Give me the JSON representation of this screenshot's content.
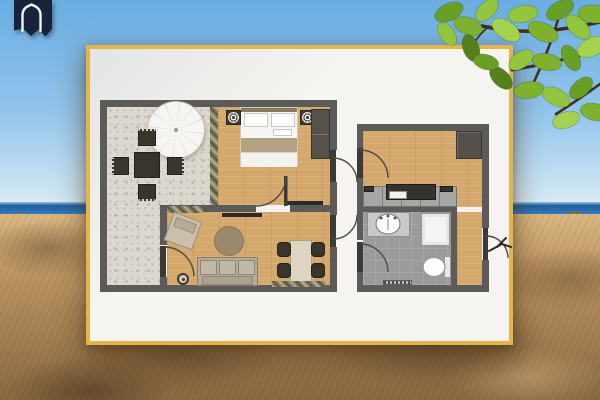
{
  "colors": {
    "sky_top": "#69ade2",
    "sky_mid": "#93c5ec",
    "sky_horizon": "#d8eaf5",
    "sea": "#2e74b5",
    "sea_dark": "#1d5f9f",
    "sand": "#bf9663",
    "sand_light": "#dcb983",
    "sand_dark": "#8a6a42",
    "sand_deep": "#5a4226",
    "card_bg": "#f6f4f0",
    "card_border": "#e5b44a",
    "wall": "#5c5b59",
    "wood": "#d5a96d",
    "patio": "#dcd8d0",
    "bath_floor": "#9c9b99",
    "entry_wood": "#d8ae75",
    "cabinet": "#a7a7a5",
    "counter_dark": "#343330",
    "furn_dark": "#38352c",
    "sofa": "#b6ac9a",
    "rug": "#9b8a6d",
    "table_cream": "#ded5c2",
    "blanket_tan": "#b2a183",
    "wardrobe": "#56524b",
    "hedge_a": "#7d8560",
    "hedge_b": "#66604e",
    "leaf_1": "#7fb02e",
    "leaf_2": "#94c53e",
    "leaf_3": "#689f25",
    "leaf_4": "#a6d14e",
    "leaf_5": "#55801c",
    "branch": "#42301e",
    "arc": "#4c4b49",
    "logo_navy": "#16233a",
    "logo_mark": "#f2f2f0"
  },
  "logo": {
    "icon": "house-arch-ribbon-icon"
  },
  "background": {
    "sky": "clear blue sky",
    "sea": "ocean horizon band",
    "beach": "sandy beach foreground",
    "foliage": "green tree branch overhanging top-right corner"
  },
  "card": {
    "kind": "white card with gold border holding the floor plan"
  },
  "floor_plan": {
    "style": "2d rendered top view, no text labels",
    "rooms": [
      {
        "name": "patio-terrace",
        "furniture": [
          "parasol",
          "outdoor-dining-table",
          "outdoor-chair x4"
        ]
      },
      {
        "name": "bedroom",
        "furniture": [
          "double-bed",
          "ceiling-light x2",
          "wardrobe",
          "planter-hedge"
        ]
      },
      {
        "name": "living-room",
        "furniture": [
          "sofa",
          "armchair",
          "round-rug",
          "dining-table",
          "dining-chair x4",
          "potted-plant",
          "tv-console",
          "wall-shelf",
          "wall-plants x2"
        ]
      },
      {
        "name": "kitchen",
        "furniture": [
          "kitchen-counter",
          "cooktop",
          "corner-cabinet"
        ]
      },
      {
        "name": "bathroom",
        "furniture": [
          "vanity-sink",
          "shower",
          "toilet",
          "bath-mat"
        ]
      },
      {
        "name": "entry-hall",
        "furniture": [
          "entry-door"
        ]
      }
    ],
    "door_symbols": 7
  }
}
